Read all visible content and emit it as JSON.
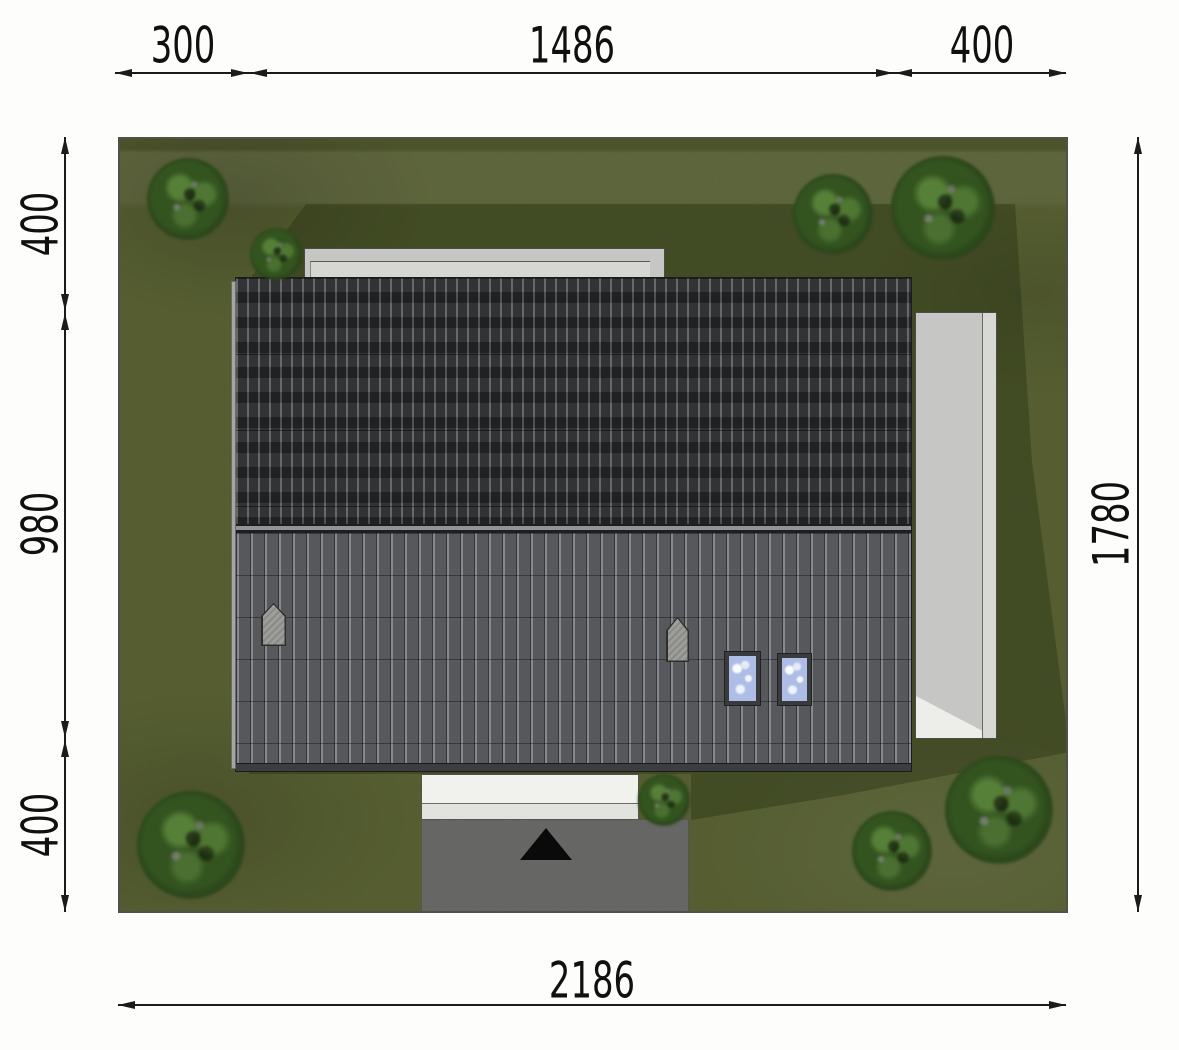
{
  "title": "house-site-plan",
  "dimensions": {
    "top": [
      {
        "label": "300"
      },
      {
        "label": "1486"
      },
      {
        "label": "400"
      }
    ],
    "left": [
      {
        "label": "400"
      },
      {
        "label": "980"
      },
      {
        "label": "400"
      }
    ],
    "right": [
      {
        "label": "1780"
      }
    ],
    "bottom": [
      {
        "label": "2186"
      }
    ]
  },
  "colors": {
    "grass": "#7b8747",
    "grass_shadow": "rgba(25,38,10,0.32)",
    "roof_dark": "#27282a",
    "roof_light": "#56585b",
    "terrace": "#c6c6c5",
    "walkway": "#f1f1ee",
    "driveway": "#9e9e9c",
    "skylight_glass": "#aebde6",
    "tree": "#33541f",
    "dimension_ink": "#1b1b1b"
  },
  "trees": [
    {
      "x": 68,
      "y": 60,
      "r": 41
    },
    {
      "x": 156,
      "y": 115,
      "r": 26
    },
    {
      "x": 713,
      "y": 75,
      "r": 40
    },
    {
      "x": 823,
      "y": 69,
      "r": 52
    },
    {
      "x": 71,
      "y": 706,
      "r": 54
    },
    {
      "x": 544,
      "y": 661,
      "r": 26
    },
    {
      "x": 772,
      "y": 712,
      "r": 40
    },
    {
      "x": 879,
      "y": 671,
      "r": 54
    }
  ]
}
